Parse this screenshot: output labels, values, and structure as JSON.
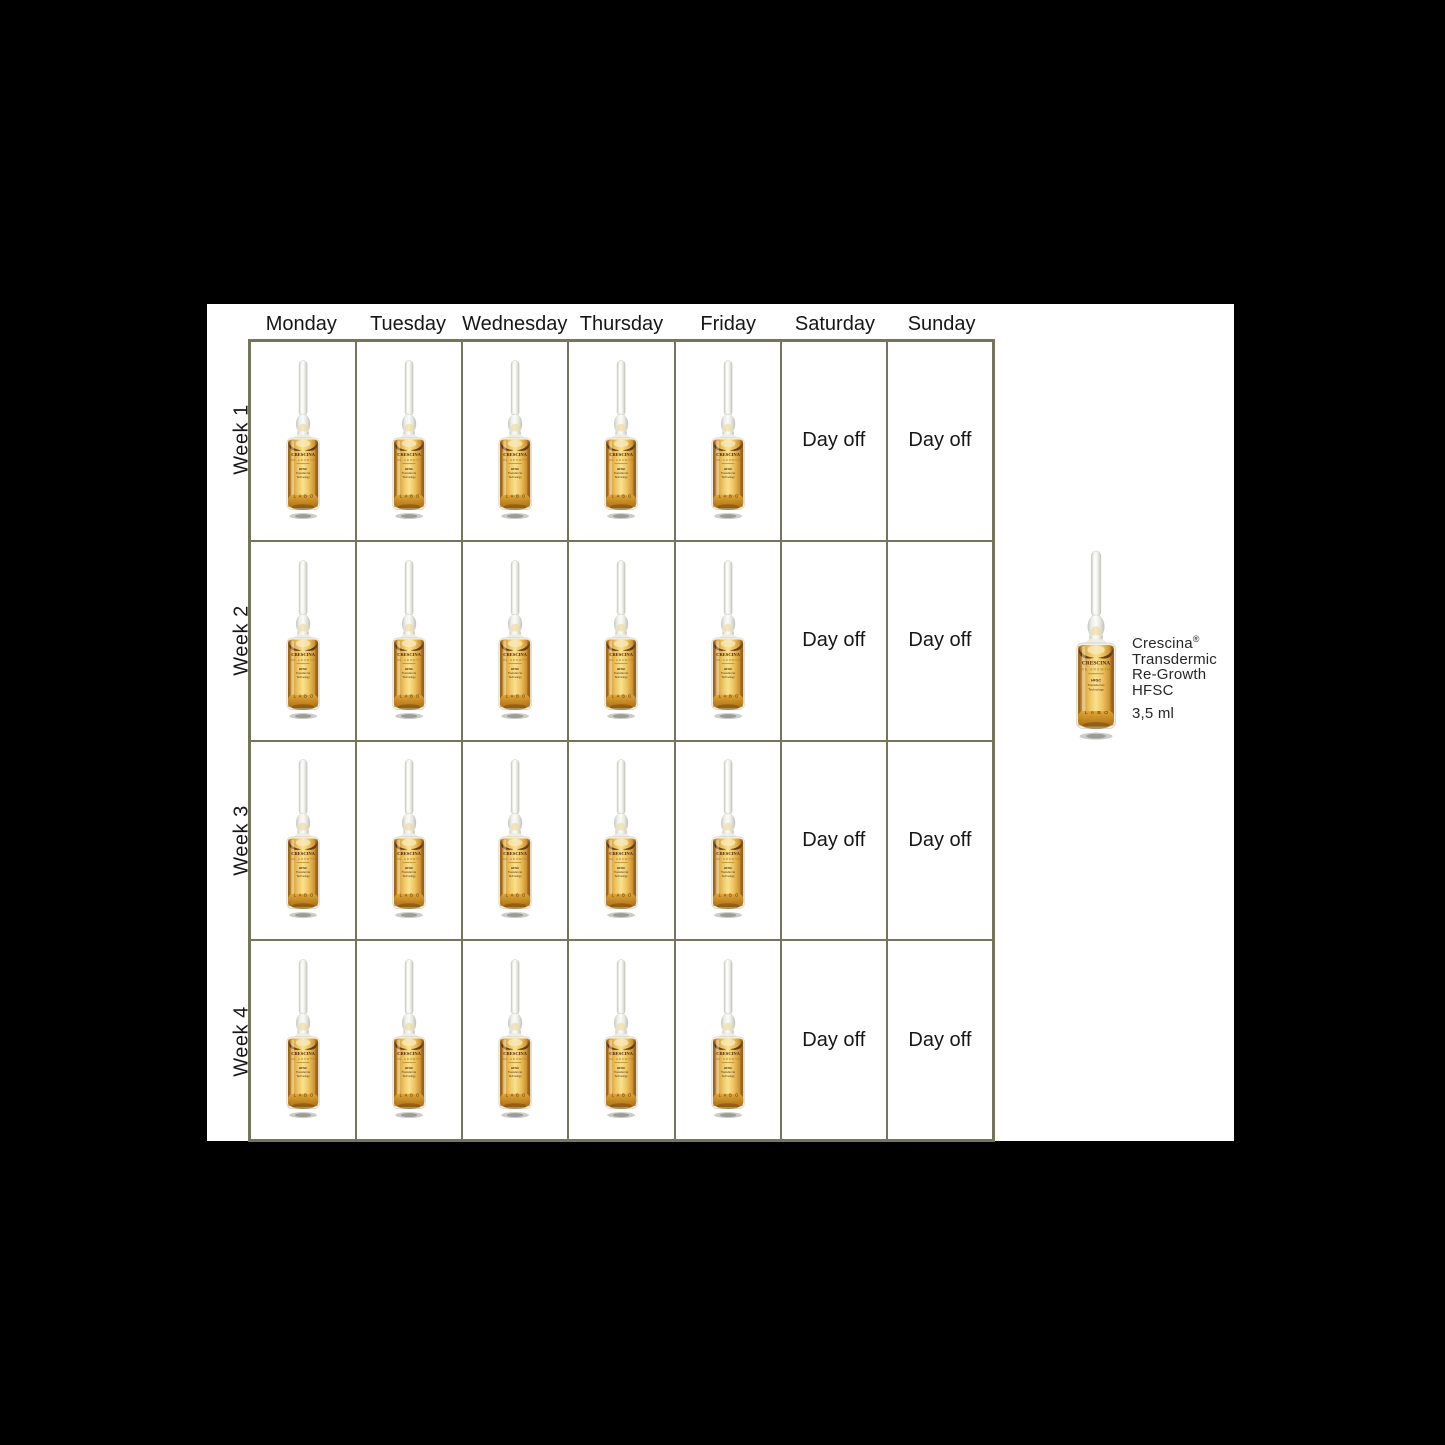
{
  "calendar": {
    "day_headers": [
      "Monday",
      "Tuesday",
      "Wednesday",
      "Thursday",
      "Friday",
      "Saturday",
      "Sunday"
    ],
    "week_labels": [
      "Week 1",
      "Week 2",
      "Week 3",
      "Week 4"
    ],
    "day_off_label": "Day off"
  },
  "product": {
    "brand": "Crescina",
    "registered_mark": "®",
    "name_line_2": "Transdermic",
    "name_line_3": "Re-Growth",
    "name_line_4": "HFSC",
    "volume": "3,5 ml",
    "ampoule_label": {
      "brand": "CRESCINA",
      "range": "RE-GROWTH",
      "tech_1": "HFSC",
      "tech_2": "Transdermic",
      "tech_3": "Technology",
      "maker": "L A B O"
    }
  },
  "colors": {
    "background": "#000000",
    "canvas": "#ffffff",
    "grid_line": "#75755c",
    "text": "#161616",
    "liquid_gold": "#eec45f",
    "label_brown": "#4f2410"
  }
}
